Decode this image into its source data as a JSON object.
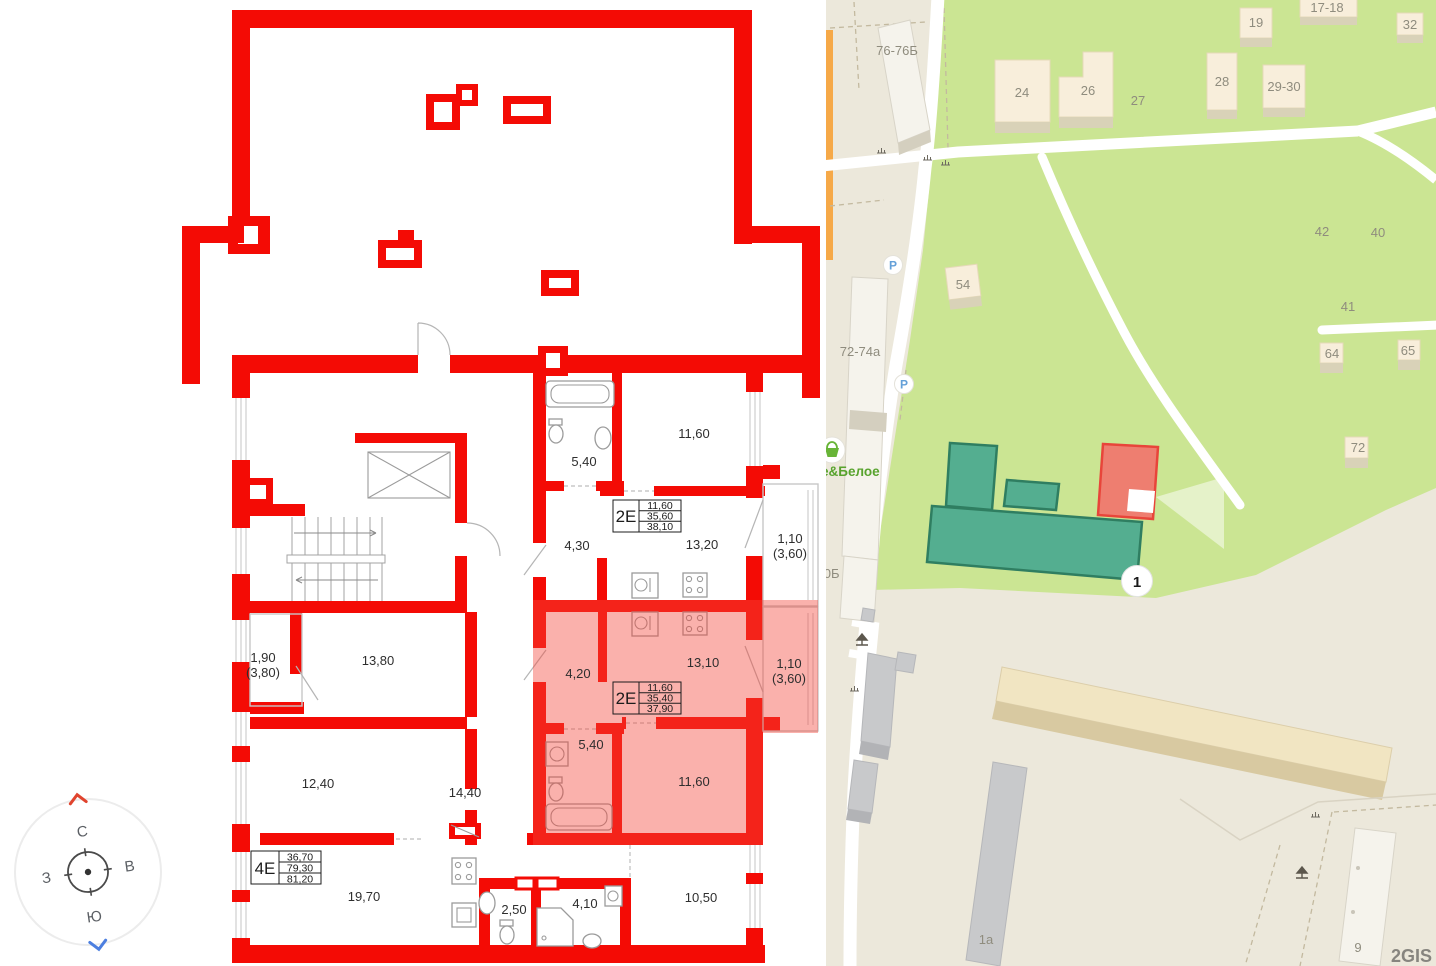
{
  "plan": {
    "apartments": [
      {
        "type": "2Е",
        "living_area": "11,60",
        "area": "35,60",
        "total_area": "38,10"
      },
      {
        "type": "2Е",
        "living_area": "11,60",
        "area": "35,40",
        "total_area": "37,90"
      },
      {
        "type": "4Е",
        "living_area": "36,70",
        "area": "79,30",
        "total_area": "81,20"
      }
    ],
    "rooms": [
      {
        "label": "5,40"
      },
      {
        "label": "11,60"
      },
      {
        "label": "4,30"
      },
      {
        "label": "13,20"
      },
      {
        "label": "1,10"
      },
      {
        "label": "(3,60)"
      },
      {
        "label": "4,20"
      },
      {
        "label": "13,10"
      },
      {
        "label": "1,10"
      },
      {
        "label": "(3,60)"
      },
      {
        "label": "5,40"
      },
      {
        "label": "11,60"
      },
      {
        "label": "1,90"
      },
      {
        "label": "(3,80)"
      },
      {
        "label": "13,80"
      },
      {
        "label": "12,40"
      },
      {
        "label": "14,40"
      },
      {
        "label": "19,70"
      },
      {
        "label": "2,50"
      },
      {
        "label": "4,10"
      },
      {
        "label": "10,50"
      }
    ],
    "compass": {
      "north": "С",
      "east": "В",
      "south": "Ю",
      "west": "З"
    },
    "colors": {
      "wall_red": "#f40b05",
      "highlight": "#f4453a"
    }
  },
  "map": {
    "attribution": "2GIS",
    "marker_label": "1",
    "parking_label": "P",
    "store_name": "е&Белое",
    "labels": [
      {
        "text": "76-76Б"
      },
      {
        "text": "24"
      },
      {
        "text": "26"
      },
      {
        "text": "27"
      },
      {
        "text": "19"
      },
      {
        "text": "17-18"
      },
      {
        "text": "32"
      },
      {
        "text": "28"
      },
      {
        "text": "29-30"
      },
      {
        "text": "42"
      },
      {
        "text": "40"
      },
      {
        "text": "41"
      },
      {
        "text": "54"
      },
      {
        "text": "64"
      },
      {
        "text": "65"
      },
      {
        "text": "72"
      },
      {
        "text": "72-74а"
      },
      {
        "text": "70Б"
      },
      {
        "text": "1а"
      },
      {
        "text": "9"
      }
    ],
    "colors": {
      "park_green": "#cbe593",
      "complex_green": "#54ae90",
      "selected_red": "#ee7e70"
    }
  }
}
